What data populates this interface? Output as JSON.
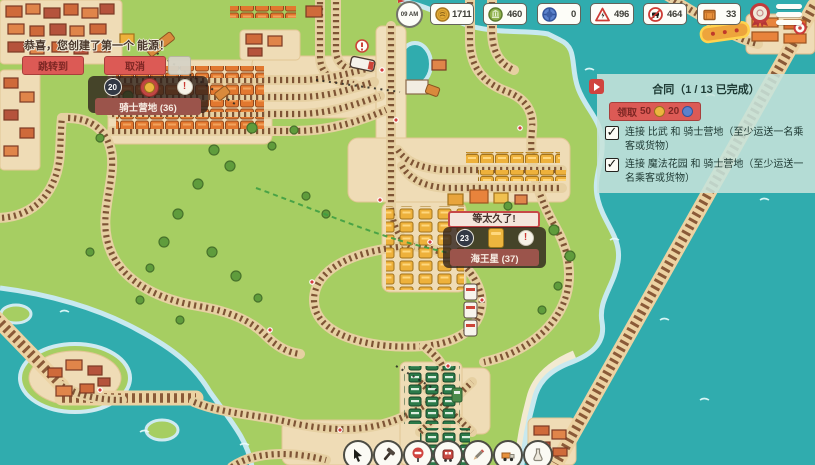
{
  "hud": {
    "clock_time": "09 AM",
    "resources": [
      {
        "icon": "gold-coin-icon",
        "value": "1711"
      },
      {
        "icon": "green-token-icon",
        "value": "460"
      },
      {
        "icon": "blue-token-icon",
        "value": "0"
      },
      {
        "icon": "electricity-warning-icon",
        "value": "496"
      },
      {
        "icon": "train-limit-icon",
        "value": "464"
      },
      {
        "icon": "crate-icon",
        "value": "33"
      }
    ]
  },
  "notification": {
    "message": "恭喜，您创建了第一个 能源！",
    "jump_button": "跳转到",
    "cancel_button": "取消"
  },
  "stations": {
    "knight_camp": {
      "name": "骑士营地 (36)",
      "badge": "20",
      "alert_symbol": "!"
    },
    "neptune": {
      "name": "海王星 (37)",
      "badge": "23",
      "alert_symbol": "!",
      "warning": "等太久了!"
    }
  },
  "contract": {
    "title": "合同（1 / 13 已完成）",
    "claim_label": "领取",
    "claim_gold": "50",
    "claim_blue": "20",
    "check_glyph": "✓",
    "objectives": [
      {
        "checked": true,
        "text": "连接 比武 和 骑士营地（至少运送一名乘客或货物）"
      },
      {
        "checked": true,
        "text": "连接 魔法花园 和 骑士营地（至少运送一名乘客或货物）"
      }
    ]
  }
}
